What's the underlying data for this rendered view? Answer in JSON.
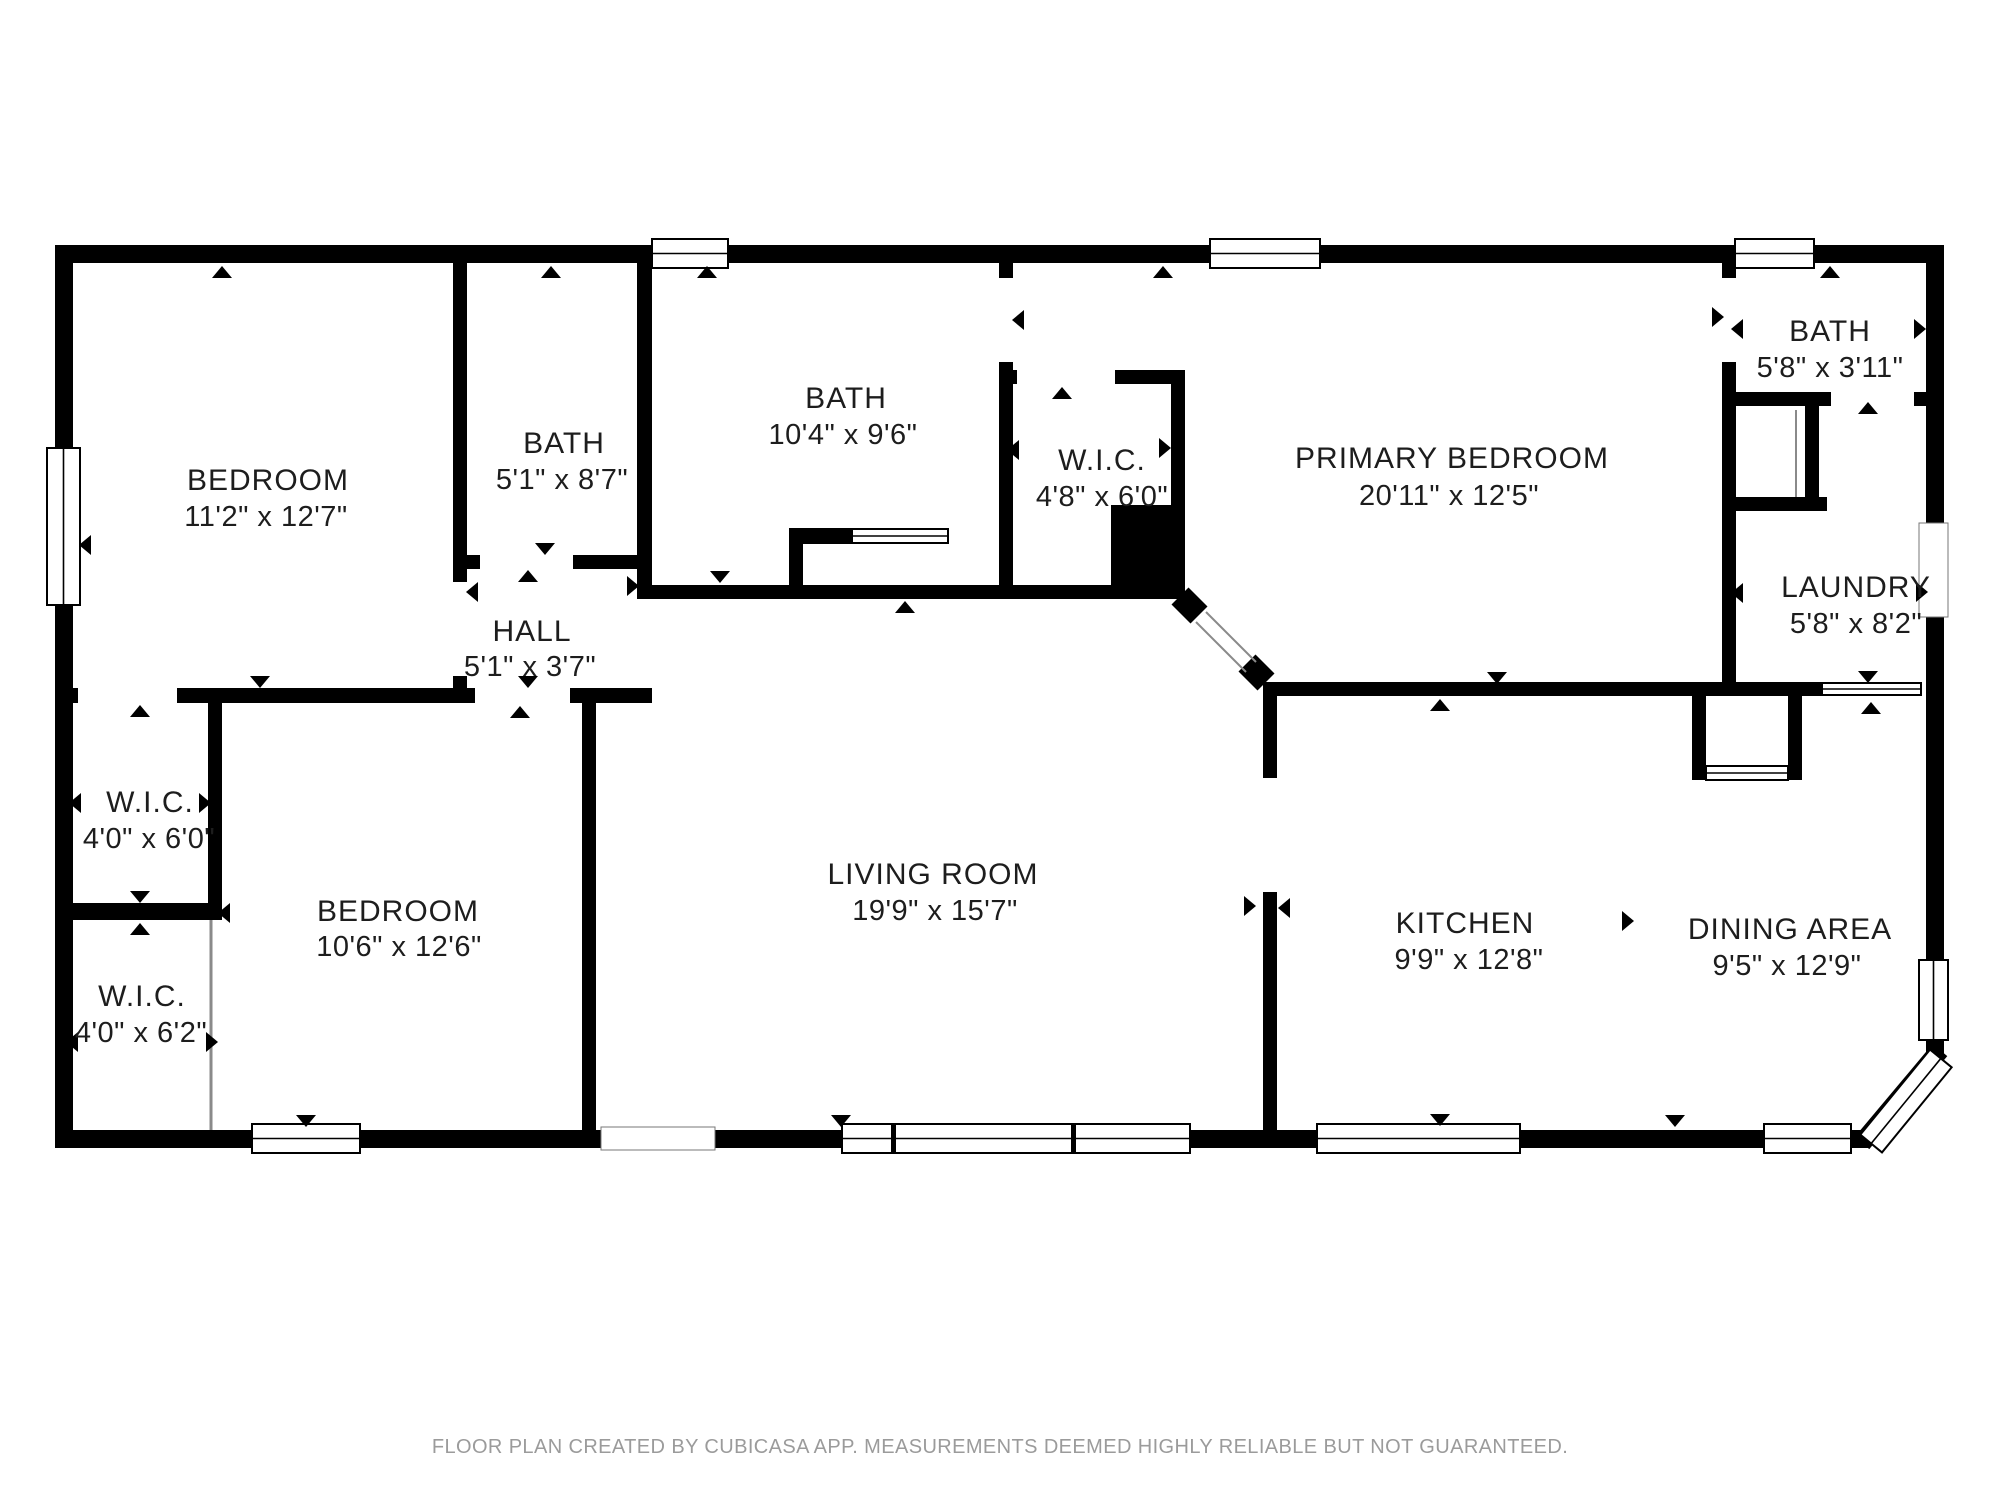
{
  "footer": {
    "disclaimer": "FLOOR PLAN CREATED BY CUBICASA APP. MEASUREMENTS DEEMED HIGHLY RELIABLE BUT NOT GUARANTEED."
  },
  "colors": {
    "wall": "#000000",
    "floor": "#ffffff",
    "label_text": "#1d1d1d",
    "footer_text": "#9b9b9b",
    "window_fill": "#ffffff",
    "window_border": "#000000",
    "thin_line": "#8a8a8a"
  },
  "floorplan": {
    "rooms": [
      {
        "name": "BEDROOM",
        "dims": "11'2\" x 12'7\"",
        "x": 268,
        "y": 490,
        "dx": 266,
        "dy": 526
      },
      {
        "name": "BATH",
        "dims": "5'1\" x 8'7\"",
        "x": 564,
        "y": 453,
        "dx": 562,
        "dy": 489
      },
      {
        "name": "BATH",
        "dims": "10'4\" x 9'6\"",
        "x": 846,
        "y": 408,
        "dx": 843,
        "dy": 444
      },
      {
        "name": "W.I.C.",
        "dims": "4'8\" x 6'0\"",
        "x": 1102,
        "y": 470,
        "dx": 1102,
        "dy": 506
      },
      {
        "name": "PRIMARY BEDROOM",
        "dims": "20'11\" x 12'5\"",
        "x": 1452,
        "y": 468,
        "dx": 1449,
        "dy": 505
      },
      {
        "name": "BATH",
        "dims": "5'8\" x 3'11\"",
        "x": 1830,
        "y": 341,
        "dx": 1830,
        "dy": 377
      },
      {
        "name": "LAUNDRY",
        "dims": "5'8\" x 8'2\"",
        "x": 1856,
        "y": 597,
        "dx": 1856,
        "dy": 633
      },
      {
        "name": "HALL",
        "dims": "5'1\" x 3'7\"",
        "x": 532,
        "y": 641,
        "dx": 530,
        "dy": 676
      },
      {
        "name": "W.I.C.",
        "dims": "4'0\" x 6'0\"",
        "x": 150,
        "y": 812,
        "dx": 149,
        "dy": 848
      },
      {
        "name": "BEDROOM",
        "dims": "10'6\" x 12'6\"",
        "x": 398,
        "y": 921,
        "dx": 399,
        "dy": 956
      },
      {
        "name": "W.I.C.",
        "dims": "4'0\" x 6'2\"",
        "x": 142,
        "y": 1006,
        "dx": 141,
        "dy": 1042
      },
      {
        "name": "LIVING ROOM",
        "dims": "19'9\" x 15'7\"",
        "x": 933,
        "y": 884,
        "dx": 935,
        "dy": 920
      },
      {
        "name": "KITCHEN",
        "dims": "9'9\" x 12'8\"",
        "x": 1465,
        "y": 933,
        "dx": 1469,
        "dy": 969
      },
      {
        "name": "DINING AREA",
        "dims": "9'5\" x 12'9\"",
        "x": 1790,
        "y": 939,
        "dx": 1787,
        "dy": 975
      }
    ],
    "walls": [
      [
        55,
        245,
        1889,
        18
      ],
      [
        55,
        245,
        18,
        903
      ],
      [
        55,
        1130,
        1813,
        18
      ],
      [
        1926,
        245,
        18,
        810
      ],
      [
        453,
        263,
        14,
        319
      ],
      [
        453,
        676,
        14,
        15
      ],
      [
        465,
        555,
        15,
        14
      ],
      [
        573,
        555,
        64,
        14
      ],
      [
        637,
        263,
        15,
        322
      ],
      [
        637,
        585,
        548,
        14
      ],
      [
        789,
        528,
        63,
        16
      ],
      [
        789,
        544,
        14,
        45
      ],
      [
        999,
        263,
        14,
        15
      ],
      [
        999,
        362,
        14,
        8
      ],
      [
        999,
        370,
        18,
        14
      ],
      [
        1115,
        370,
        70,
        14
      ],
      [
        999,
        370,
        14,
        215
      ],
      [
        1171,
        370,
        14,
        135
      ],
      [
        1111,
        505,
        74,
        94
      ],
      [
        1263,
        682,
        14,
        96
      ],
      [
        1263,
        892,
        14,
        238
      ],
      [
        1277,
        682,
        428,
        14
      ],
      [
        1705,
        682,
        117,
        14
      ],
      [
        1692,
        696,
        14,
        84
      ],
      [
        1788,
        696,
        14,
        84
      ],
      [
        1722,
        263,
        14,
        15
      ],
      [
        1722,
        362,
        14,
        334
      ],
      [
        1736,
        392,
        95,
        14
      ],
      [
        1914,
        392,
        12,
        14
      ],
      [
        1805,
        406,
        14,
        105
      ],
      [
        1736,
        497,
        91,
        14
      ],
      [
        55,
        688,
        23,
        15
      ],
      [
        177,
        688,
        298,
        15
      ],
      [
        570,
        688,
        82,
        15
      ],
      [
        582,
        688,
        14,
        442
      ],
      [
        55,
        903,
        153,
        17
      ],
      [
        208,
        688,
        14,
        232
      ]
    ],
    "diagonal_walls": [
      {
        "x1": 1862,
        "y1": 1143,
        "x2": 1940,
        "y2": 1050,
        "w": 19
      },
      {
        "x1": 1180,
        "y1": 596,
        "x2": 1199,
        "y2": 615,
        "w": 24
      },
      {
        "x1": 1247,
        "y1": 663,
        "x2": 1266,
        "y2": 682,
        "w": 24
      }
    ],
    "thin_lines": [
      {
        "x1": 1206,
        "y1": 612,
        "x2": 1256,
        "y2": 662,
        "w": 2
      },
      {
        "x1": 1196,
        "y1": 622,
        "x2": 1246,
        "y2": 672,
        "w": 2
      },
      {
        "x1": 211,
        "y1": 920,
        "x2": 211,
        "y2": 1130,
        "w": 3
      },
      {
        "x1": 1796,
        "y1": 410,
        "x2": 1796,
        "y2": 497,
        "w": 2
      }
    ],
    "windows": [
      {
        "x": 47,
        "y": 448,
        "w": 33,
        "h": 157,
        "dir": "v",
        "style": "lined"
      },
      {
        "x": 652,
        "y": 239,
        "w": 76,
        "h": 29,
        "dir": "h",
        "style": "lined"
      },
      {
        "x": 1210,
        "y": 239,
        "w": 110,
        "h": 29,
        "dir": "h",
        "style": "lined"
      },
      {
        "x": 1735,
        "y": 239,
        "w": 79,
        "h": 29,
        "dir": "h",
        "style": "lined"
      },
      {
        "x": 252,
        "y": 1124,
        "w": 108,
        "h": 29,
        "dir": "h",
        "style": "lined"
      },
      {
        "x": 601,
        "y": 1127,
        "w": 114,
        "h": 23,
        "dir": "h",
        "style": "plain"
      },
      {
        "x": 842,
        "y": 1124,
        "w": 348,
        "h": 29,
        "dir": "h",
        "style": "lined",
        "posts": [
          891,
          1071
        ]
      },
      {
        "x": 1317,
        "y": 1124,
        "w": 203,
        "h": 29,
        "dir": "h",
        "style": "lined"
      },
      {
        "x": 1764,
        "y": 1124,
        "w": 87,
        "h": 29,
        "dir": "h",
        "style": "lined"
      },
      {
        "x": 1919,
        "y": 960,
        "w": 29,
        "h": 80,
        "dir": "v",
        "style": "lined"
      },
      {
        "x": 1919,
        "y": 523,
        "w": 29,
        "h": 94,
        "dir": "v",
        "style": "plain"
      },
      {
        "x": 1851,
        "y": 1087,
        "w": 110,
        "h": 28,
        "dir": "h",
        "style": "lined",
        "rotate": -50.7,
        "cx": 1906,
        "cy": 1101
      },
      {
        "x": 1706,
        "y": 766,
        "w": 82,
        "h": 14,
        "dir": "h",
        "style": "lined"
      },
      {
        "x": 852,
        "y": 529,
        "w": 96,
        "h": 14,
        "dir": "h",
        "style": "lined"
      },
      {
        "x": 1822,
        "y": 683,
        "w": 99,
        "h": 12,
        "dir": "h",
        "style": "lined"
      }
    ],
    "door_markers": [
      {
        "x": 222,
        "y": 272,
        "dir": "up"
      },
      {
        "x": 551,
        "y": 272,
        "dir": "up"
      },
      {
        "x": 707,
        "y": 272,
        "dir": "up"
      },
      {
        "x": 1163,
        "y": 272,
        "dir": "up"
      },
      {
        "x": 1830,
        "y": 272,
        "dir": "up"
      },
      {
        "x": 85,
        "y": 545,
        "dir": "left"
      },
      {
        "x": 472,
        "y": 592,
        "dir": "left"
      },
      {
        "x": 545,
        "y": 549,
        "dir": "down"
      },
      {
        "x": 528,
        "y": 576,
        "dir": "up"
      },
      {
        "x": 633,
        "y": 586,
        "dir": "right"
      },
      {
        "x": 528,
        "y": 682,
        "dir": "down"
      },
      {
        "x": 520,
        "y": 712,
        "dir": "up"
      },
      {
        "x": 260,
        "y": 682,
        "dir": "down"
      },
      {
        "x": 140,
        "y": 711,
        "dir": "up"
      },
      {
        "x": 140,
        "y": 897,
        "dir": "down"
      },
      {
        "x": 140,
        "y": 929,
        "dir": "up"
      },
      {
        "x": 224,
        "y": 913,
        "dir": "left"
      },
      {
        "x": 75,
        "y": 803,
        "dir": "left"
      },
      {
        "x": 205,
        "y": 803,
        "dir": "right"
      },
      {
        "x": 72,
        "y": 1042,
        "dir": "left"
      },
      {
        "x": 212,
        "y": 1042,
        "dir": "right"
      },
      {
        "x": 1018,
        "y": 320,
        "dir": "left"
      },
      {
        "x": 1062,
        "y": 393,
        "dir": "up"
      },
      {
        "x": 1013,
        "y": 450,
        "dir": "left"
      },
      {
        "x": 1165,
        "y": 448,
        "dir": "right"
      },
      {
        "x": 905,
        "y": 607,
        "dir": "up"
      },
      {
        "x": 720,
        "y": 577,
        "dir": "down"
      },
      {
        "x": 1250,
        "y": 906,
        "dir": "right"
      },
      {
        "x": 1284,
        "y": 908,
        "dir": "left"
      },
      {
        "x": 1497,
        "y": 678,
        "dir": "down"
      },
      {
        "x": 1440,
        "y": 705,
        "dir": "up"
      },
      {
        "x": 1718,
        "y": 317,
        "dir": "right"
      },
      {
        "x": 1737,
        "y": 329,
        "dir": "left"
      },
      {
        "x": 1920,
        "y": 329,
        "dir": "right"
      },
      {
        "x": 1737,
        "y": 593,
        "dir": "left"
      },
      {
        "x": 1922,
        "y": 592,
        "dir": "right"
      },
      {
        "x": 1868,
        "y": 408,
        "dir": "up"
      },
      {
        "x": 1868,
        "y": 677,
        "dir": "down"
      },
      {
        "x": 1871,
        "y": 708,
        "dir": "up"
      },
      {
        "x": 1675,
        "y": 1121,
        "dir": "down"
      },
      {
        "x": 841,
        "y": 1121,
        "dir": "down"
      },
      {
        "x": 306,
        "y": 1121,
        "dir": "down"
      },
      {
        "x": 1440,
        "y": 1120,
        "dir": "down"
      },
      {
        "x": 1628,
        "y": 921,
        "dir": "right"
      }
    ]
  }
}
